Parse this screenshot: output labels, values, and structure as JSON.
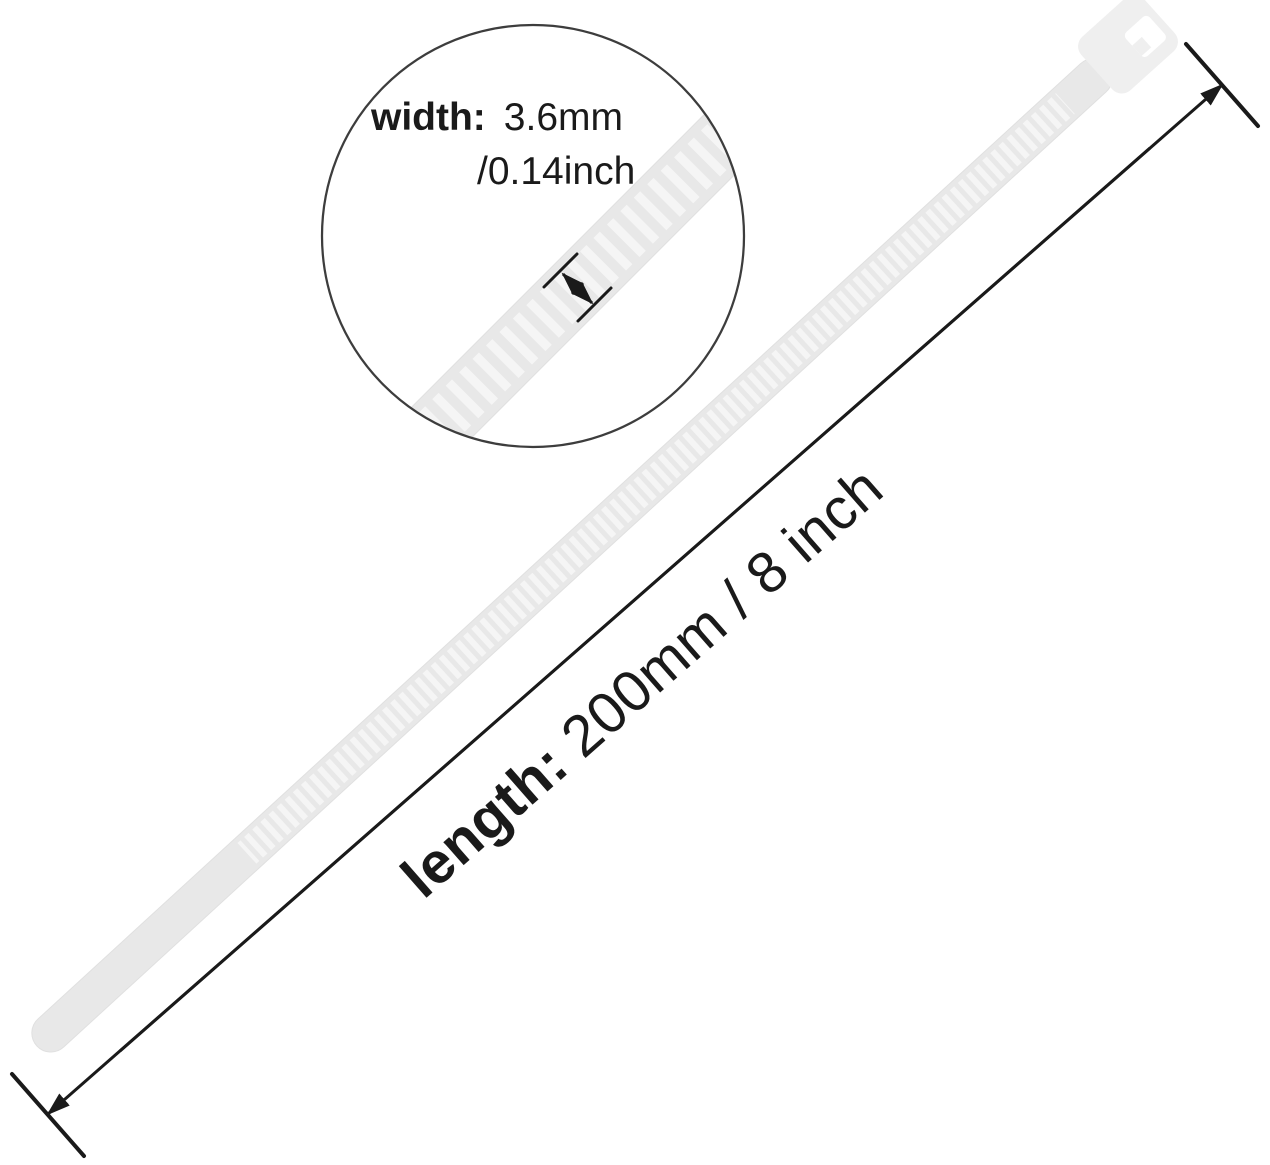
{
  "product": {
    "name": "cable-tie"
  },
  "callout": {
    "label": "width:",
    "metric": "3.6mm",
    "imperial": "/0.14inch"
  },
  "dimension": {
    "label": "length:",
    "value": "200mm / 8 inch"
  },
  "colors": {
    "background": "#ffffff",
    "tie_fill": "#e8e8e8",
    "tie_tooth": "#f5f5f5",
    "tie_edge": "#e0e0e0",
    "head_fill": "#efefef",
    "slot_fill": "#ffffff",
    "line": "#1a1a1a",
    "circle_stroke": "#3d3d3d",
    "text": "#1a1a1a"
  }
}
